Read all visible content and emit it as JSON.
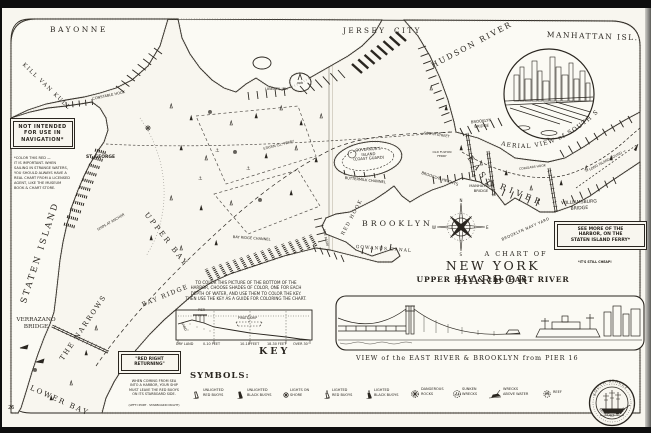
{
  "scan": {
    "left_page_number": "26",
    "right_page_number": "27"
  },
  "title": {
    "kicker": "A CHART OF",
    "main": "NEW YORK HARBOR",
    "sub": "UPPER BAY & the EAST RIVER"
  },
  "inset": {
    "caption": "AERIAL VIEW of SOUTH STREET"
  },
  "panorama": {
    "caption": "VIEW of the EAST RIVER & BROOKLYN from PIER 16"
  },
  "seal": {
    "top": "SOUTH STREET",
    "bottom": "SEAPORT MUSEUM"
  },
  "compass": {
    "n": "N",
    "e": "E",
    "s": "S",
    "w": "W"
  },
  "boxes": {
    "not_intended": {
      "text": "NOT INTENDED\nFOR USE IN\nNAVIGATION*"
    },
    "color_note": {
      "text": "*COLOR THIS RED —\nIT IS IMPORTANT. WHEN\nSAILING IN STRANGE WATERS,\nYOU SHOULD ALWAYS HAVE A\nREAL CHART FROM A LICENSED\nAGENT, LIKE THE MUSEUM\nBOOK & CHART STORE."
    },
    "red_right": {
      "title": "\"RED RIGHT\nRETURNING\"",
      "note": "WHEN COMING FROM SEA\nINTO A HARBOR, YOUR SHIP\nMUST LEAVE THE RED BUOYS\nON ITS STARBOARD SIDE.",
      "footnote": "(LEFT=PORT · STARBOARD=RIGHT)"
    },
    "ferry_ad": {
      "text": "SEE MORE OF THE\nHARBOR, ON THE\nSTATEN ISLAND FERRY*",
      "footnote": "*IT'S STILL CHEAP!"
    }
  },
  "key": {
    "instructions": "TO COLOR THIS PICTURE OF THE BOTTOM OF THE\nHARBOR, CHOOSE SHADES OF COLOR, ONE FOR EACH\nDEPTH OF WATER, AND USE THEM TO COLOR THE KEY.\nTHEN USE THE KEY AS A GUIDE FOR COLORING THE CHART.",
    "heading": "KEY",
    "depth_labels": [
      "DRY LAND",
      "0-10 FEET",
      "10-18 FEET",
      "18-30 FEET",
      "OVER 30'"
    ],
    "cross_section": {
      "sand": "SAND",
      "pier": "PIER",
      "ship": "PIRATE SHIP"
    }
  },
  "symbols": {
    "heading": "SYMBOLS:",
    "items": [
      {
        "glyph": "red-buoy-unlighted-icon",
        "label": "UNLIGHTED\nRED BUOYS"
      },
      {
        "glyph": "black-buoy-unlighted-icon",
        "label": "UNLIGHTED\nBLACK BUOYS"
      },
      {
        "glyph": "shore-light-icon",
        "label": "LIGHTS ON\nSHORE"
      },
      {
        "glyph": "red-buoy-lighted-icon",
        "label": "LIGHTED\nRED BUOYS"
      },
      {
        "glyph": "black-buoy-lighted-icon",
        "label": "LIGHTED\nBLACK BUOYS"
      },
      {
        "glyph": "dangerous-rocks-icon",
        "label": "DANGEROUS\nROCKS"
      },
      {
        "glyph": "sunken-wreck-icon",
        "label": "SUNKEN\nWRECKS"
      },
      {
        "glyph": "wreck-above-water-icon",
        "label": "WRECKS\nABOVE WATER"
      },
      {
        "glyph": "reef-icon",
        "label": "REEF"
      }
    ]
  },
  "map_labels": [
    {
      "t": "BAYONNE",
      "x": 50,
      "y": 26,
      "s": 7.5,
      "ls": 2.5,
      "f": 1
    },
    {
      "t": "KILL VAN KULL",
      "x": 25,
      "y": 62,
      "s": 5.5,
      "ls": 1.5,
      "r": 44,
      "f": 1
    },
    {
      "t": "CONSTABLE HOOK",
      "x": 92,
      "y": 97,
      "s": 3.6,
      "r": -12
    },
    {
      "t": "ST. GEORGE",
      "x": 86,
      "y": 155,
      "s": 4.4,
      "b": 1
    },
    {
      "t": "STATEN ISLAND",
      "x": 20,
      "y": 302,
      "s": 8.5,
      "ls": 2.5,
      "r": -72,
      "f": 1
    },
    {
      "t": "VERRAZANO\nBRIDGE",
      "x": 14,
      "y": 317,
      "s": 5.8,
      "w": 44,
      "f": 1,
      "lh": 1.25
    },
    {
      "t": "THE NARROWS",
      "x": 59,
      "y": 358,
      "s": 6.8,
      "ls": 2,
      "r": -56,
      "f": 1
    },
    {
      "t": "LOWER BAY",
      "x": 32,
      "y": 384,
      "s": 7.2,
      "ls": 2,
      "r": 24,
      "f": 1
    },
    {
      "t": "BAY RIDGE",
      "x": 141,
      "y": 302,
      "s": 6.2,
      "ls": 1.5,
      "r": -22,
      "f": 1
    },
    {
      "t": "UPPER BAY",
      "x": 149,
      "y": 211,
      "s": 7.2,
      "ls": 2.5,
      "r": 52,
      "f": 1
    },
    {
      "t": "SHIPS AT ANCHOR",
      "x": 97,
      "y": 229,
      "s": 3.4,
      "r": -30
    },
    {
      "t": "BAY RIDGE CHANNEL",
      "x": 233,
      "y": 235,
      "s": 3.6,
      "r": 4
    },
    {
      "t": "STATEN ISL. FERRY",
      "x": 263,
      "y": 148,
      "s": 3.4,
      "r": -14
    },
    {
      "t": "LIBERTY ISL.",
      "x": 265,
      "y": 87,
      "s": 3.8
    },
    {
      "t": "GOVERNOR'S\nISLAND\n(COAST GUARD)",
      "x": 347,
      "y": 149,
      "s": 3.8,
      "w": 42,
      "r": -4,
      "lh": 1.2
    },
    {
      "t": "BUTTERMILK CHANNEL",
      "x": 345,
      "y": 176,
      "s": 3.6,
      "r": 6
    },
    {
      "t": "RED HOOK",
      "x": 341,
      "y": 234,
      "s": 4.8,
      "ls": 1.5,
      "r": -62,
      "f": 1
    },
    {
      "t": "BROOKLYN",
      "x": 362,
      "y": 220,
      "s": 7.8,
      "ls": 3,
      "f": 1
    },
    {
      "t": "ERIE BASIN",
      "x": 325,
      "y": 229,
      "s": 3,
      "r": 78
    },
    {
      "t": "GOWANUS CANAL",
      "x": 356,
      "y": 245,
      "s": 4.4,
      "ls": 1,
      "r": 4,
      "f": 1
    },
    {
      "t": "BROOKLYN HEIGHTS",
      "x": 422,
      "y": 171,
      "s": 3.8,
      "r": 18
    },
    {
      "t": "JERSEY",
      "x": 343,
      "y": 27,
      "s": 7.2,
      "ls": 2.5,
      "f": 1
    },
    {
      "t": "CITY",
      "x": 394,
      "y": 27,
      "s": 7.2,
      "ls": 2.5,
      "f": 1
    },
    {
      "t": "HUDSON RIVER",
      "x": 430,
      "y": 63,
      "s": 7.8,
      "ls": 2,
      "r": -28,
      "f": 1
    },
    {
      "t": "MANHATTAN ISL.",
      "x": 547,
      "y": 31,
      "s": 7.5,
      "ls": 1.5,
      "r": 2,
      "f": 1
    },
    {
      "t": "SOUTH STREET",
      "x": 424,
      "y": 132,
      "s": 3.4,
      "r": 8
    },
    {
      "t": "BROOKLYN\nBRIDGE",
      "x": 465,
      "y": 121,
      "s": 3.8,
      "w": 32,
      "r": -6,
      "lh": 1.2
    },
    {
      "t": "OLD FULTON\nFERRY",
      "x": 431,
      "y": 151,
      "s": 3,
      "w": 22,
      "lh": 1.2
    },
    {
      "t": "EAST",
      "x": 473,
      "y": 154,
      "s": 8,
      "ls": 4,
      "r": 55,
      "f": 1
    },
    {
      "t": "RIVER",
      "x": 502,
      "y": 182,
      "s": 8,
      "ls": 4,
      "r": 22,
      "f": 1
    },
    {
      "t": "MANHATTAN\nBRIDGE",
      "x": 464,
      "y": 184,
      "s": 3.8,
      "w": 34,
      "lh": 1.2
    },
    {
      "t": "WILLIAMSBURG\nBRIDGE",
      "x": 548,
      "y": 202,
      "s": 4.6,
      "w": 62,
      "r": -3,
      "lh": 1.2
    },
    {
      "t": "BROOKLYN NAVY YARD",
      "x": 501,
      "y": 238,
      "s": 3.8,
      "ls": 0.5,
      "r": -24
    },
    {
      "t": "CORLEARS HOOK",
      "x": 519,
      "y": 168,
      "s": 3.1,
      "r": -8
    },
    {
      "t": "— LONG ISLAND SOUND →",
      "x": 585,
      "y": 171,
      "s": 3.4,
      "r": -28
    }
  ]
}
